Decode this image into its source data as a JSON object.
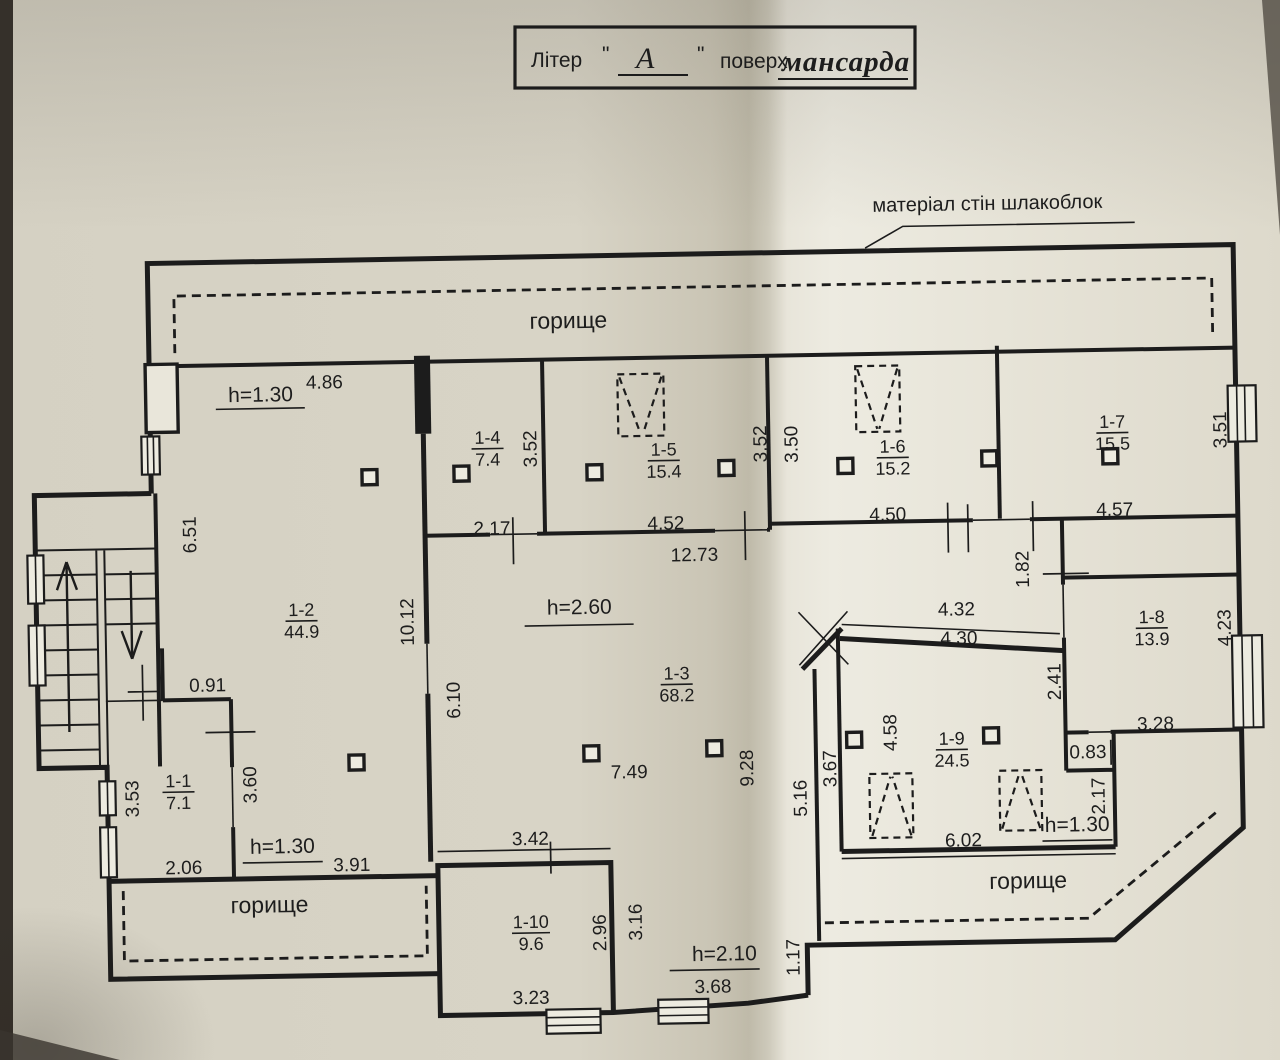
{
  "title": {
    "prefix": "Літер",
    "quote_open": "\"",
    "letter": "А",
    "quote_close": "\"",
    "floor_word": "поверх",
    "floor_value": "мансарда"
  },
  "notes": {
    "wall_material": "матеріал стін шлакоблок"
  },
  "attic": {
    "top": "горище",
    "bottom_left": "горище",
    "bottom_right": "горище"
  },
  "heights": {
    "top_left": "h=1.30",
    "center": "h=2.60",
    "bottom_left": "h=1.30",
    "bottom_center": "h=2.10",
    "bottom_right": "h=1.30"
  },
  "rooms": [
    {
      "id": "1-1",
      "area": "7.1"
    },
    {
      "id": "1-2",
      "area": "44.9"
    },
    {
      "id": "1-3",
      "area": "68.2"
    },
    {
      "id": "1-4",
      "area": "7.4"
    },
    {
      "id": "1-5",
      "area": "15.4"
    },
    {
      "id": "1-6",
      "area": "15.2"
    },
    {
      "id": "1-7",
      "area": "15.5"
    },
    {
      "id": "1-8",
      "area": "13.9"
    },
    {
      "id": "1-9",
      "area": "24.5"
    },
    {
      "id": "1-10",
      "area": "9.6"
    }
  ],
  "dimensions": {
    "horizontal": {
      "d486": "4.86",
      "d217": "2.17",
      "d452": "4.52",
      "d1273": "12.73",
      "d450": "4.50",
      "d457": "4.57",
      "d091": "0.91",
      "d432": "4.32",
      "d430": "4.30",
      "d328": "3.28",
      "d083": "0.83",
      "d749": "7.49",
      "d206": "2.06",
      "d391": "3.91",
      "d342": "3.42",
      "d602": "6.02",
      "d323": "3.23",
      "d368": "3.68"
    },
    "vertical": {
      "d651": "6.51",
      "d352a": "3.52",
      "d352b": "3.52",
      "d350": "3.50",
      "d351": "3.51",
      "d1012": "10.12",
      "d610": "6.10",
      "d182": "1.82",
      "d241": "2.41",
      "d423": "4.23",
      "d353": "3.53",
      "d360": "3.60",
      "d928": "9.28",
      "d516": "5.16",
      "d367": "3.67",
      "d458": "4.58",
      "d217r": "2.17",
      "d296": "2.96",
      "d316": "3.16",
      "d117": "1.17"
    }
  }
}
